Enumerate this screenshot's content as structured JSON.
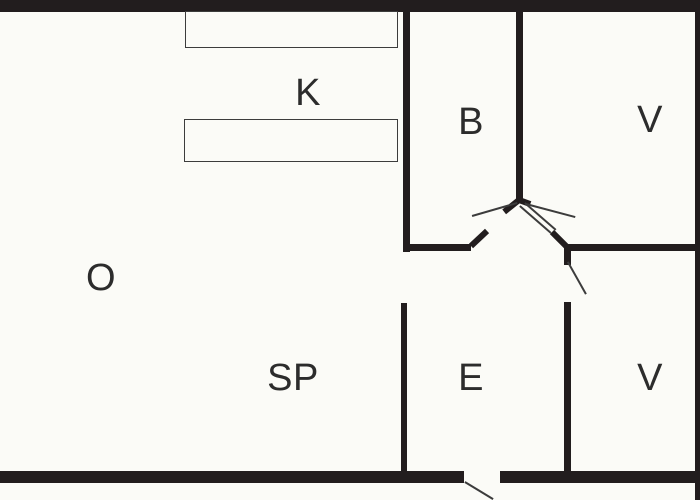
{
  "document_type": "floor-plan-diagram",
  "colors": {
    "wall": "#221d1e",
    "line": "#3c3c3c",
    "background": "#fbfbf7",
    "label": "#2c2c2c"
  },
  "rooms": [
    {
      "id": "K",
      "label": "K",
      "x": 308,
      "y": 93
    },
    {
      "id": "B",
      "label": "B",
      "x": 471,
      "y": 122
    },
    {
      "id": "V1",
      "label": "V",
      "x": 650,
      "y": 120
    },
    {
      "id": "O",
      "label": "O",
      "x": 101,
      "y": 278
    },
    {
      "id": "SP",
      "label": "SP",
      "x": 293,
      "y": 378
    },
    {
      "id": "E",
      "label": "E",
      "x": 471,
      "y": 378
    },
    {
      "id": "V2",
      "label": "V",
      "x": 650,
      "y": 378
    }
  ],
  "walls": [
    {
      "name": "wall-top",
      "x": 0,
      "y": 0,
      "w": 700,
      "h": 12
    },
    {
      "name": "wall-bottom-left",
      "x": 0,
      "y": 471,
      "w": 464,
      "h": 12
    },
    {
      "name": "wall-bottom-right",
      "x": 500,
      "y": 471,
      "w": 200,
      "h": 12
    },
    {
      "name": "wall-right-edge",
      "x": 695,
      "y": 0,
      "w": 5,
      "h": 500
    },
    {
      "name": "wall-o-b-divider",
      "x": 403,
      "y": 11,
      "w": 7,
      "h": 241
    },
    {
      "name": "wall-b-bottom",
      "x": 403,
      "y": 244,
      "w": 68,
      "h": 7
    },
    {
      "name": "wall-b-v-divider",
      "x": 516,
      "y": 11,
      "w": 7,
      "h": 191
    },
    {
      "name": "wall-v-v-divider",
      "x": 564,
      "y": 244,
      "w": 136,
      "h": 7
    },
    {
      "name": "wall-e-v-upper",
      "x": 564,
      "y": 244,
      "w": 7,
      "h": 21
    },
    {
      "name": "wall-e-v-lower",
      "x": 564,
      "y": 302,
      "w": 7,
      "h": 169
    },
    {
      "name": "wall-sp-e-divider",
      "x": 401,
      "y": 303,
      "w": 6,
      "h": 168
    }
  ],
  "segments": [
    {
      "name": "door-leaf-b",
      "x1": 471,
      "y1": 246,
      "x2": 487,
      "y2": 231,
      "t": 6,
      "role": "leaf"
    },
    {
      "name": "door-leaf-center-left",
      "x1": 519,
      "y1": 200,
      "x2": 504,
      "y2": 212,
      "t": 6,
      "role": "leaf"
    },
    {
      "name": "door-leaf-center-right",
      "x1": 519,
      "y1": 200,
      "x2": 530,
      "y2": 204,
      "t": 6,
      "role": "leaf"
    },
    {
      "name": "door-leaf-v",
      "x1": 552,
      "y1": 232,
      "x2": 568,
      "y2": 248,
      "t": 6,
      "role": "leaf"
    },
    {
      "name": "door-swing-left",
      "x1": 472,
      "y1": 216,
      "x2": 517,
      "y2": 203,
      "t": 1.6,
      "role": "swing"
    },
    {
      "name": "door-swing-right-upper",
      "x1": 526,
      "y1": 204,
      "x2": 575,
      "y2": 217,
      "t": 1.6,
      "role": "swing"
    },
    {
      "name": "door-swing-right-lower-a",
      "x1": 520,
      "y1": 206,
      "x2": 551,
      "y2": 233,
      "t": 1.6,
      "role": "swing"
    },
    {
      "name": "door-swing-right-lower-b",
      "x1": 525,
      "y1": 203,
      "x2": 556,
      "y2": 230,
      "t": 1.6,
      "role": "swing"
    },
    {
      "name": "door-swing-e-v",
      "x1": 568,
      "y1": 262,
      "x2": 586,
      "y2": 294,
      "t": 1.6,
      "role": "swing"
    },
    {
      "name": "door-swing-entrance",
      "x1": 465,
      "y1": 482,
      "x2": 493,
      "y2": 499,
      "t": 1.6,
      "role": "swing"
    }
  ],
  "fixtures": [
    {
      "name": "kitchen-counter-upper",
      "x": 185,
      "y": 11,
      "w": 213,
      "h": 37
    },
    {
      "name": "kitchen-counter-lower",
      "x": 184,
      "y": 119,
      "w": 214,
      "h": 43
    }
  ]
}
